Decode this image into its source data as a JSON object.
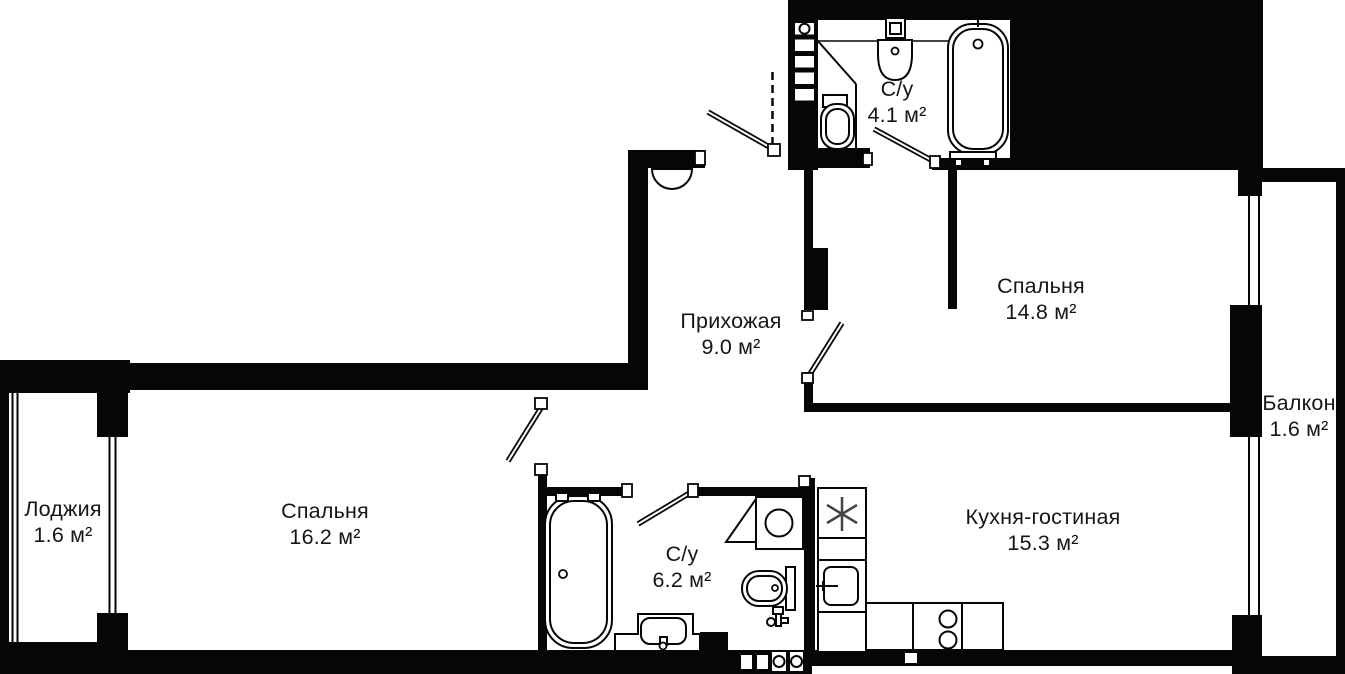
{
  "plan": {
    "background": "#ffffff",
    "wall_color": "#060606",
    "text_color": "#161616",
    "rooms": [
      {
        "id": "su-top",
        "name": "С/у",
        "area": "4.1 м²"
      },
      {
        "id": "bedroom-top",
        "name": "Спальня",
        "area": "14.8 м²"
      },
      {
        "id": "hallway",
        "name": "Прихожая",
        "area": "9.0 м²"
      },
      {
        "id": "balcony",
        "name": "Балкон",
        "area": "1.6 м²"
      },
      {
        "id": "loggia",
        "name": "Лоджия",
        "area": "1.6 м²"
      },
      {
        "id": "bedroom-left",
        "name": "Спальня",
        "area": "16.2 м²"
      },
      {
        "id": "su-bottom",
        "name": "С/у",
        "area": "6.2 м²"
      },
      {
        "id": "kitchen",
        "name": "Кухня-гостиная",
        "area": "15.3 м²"
      }
    ]
  }
}
